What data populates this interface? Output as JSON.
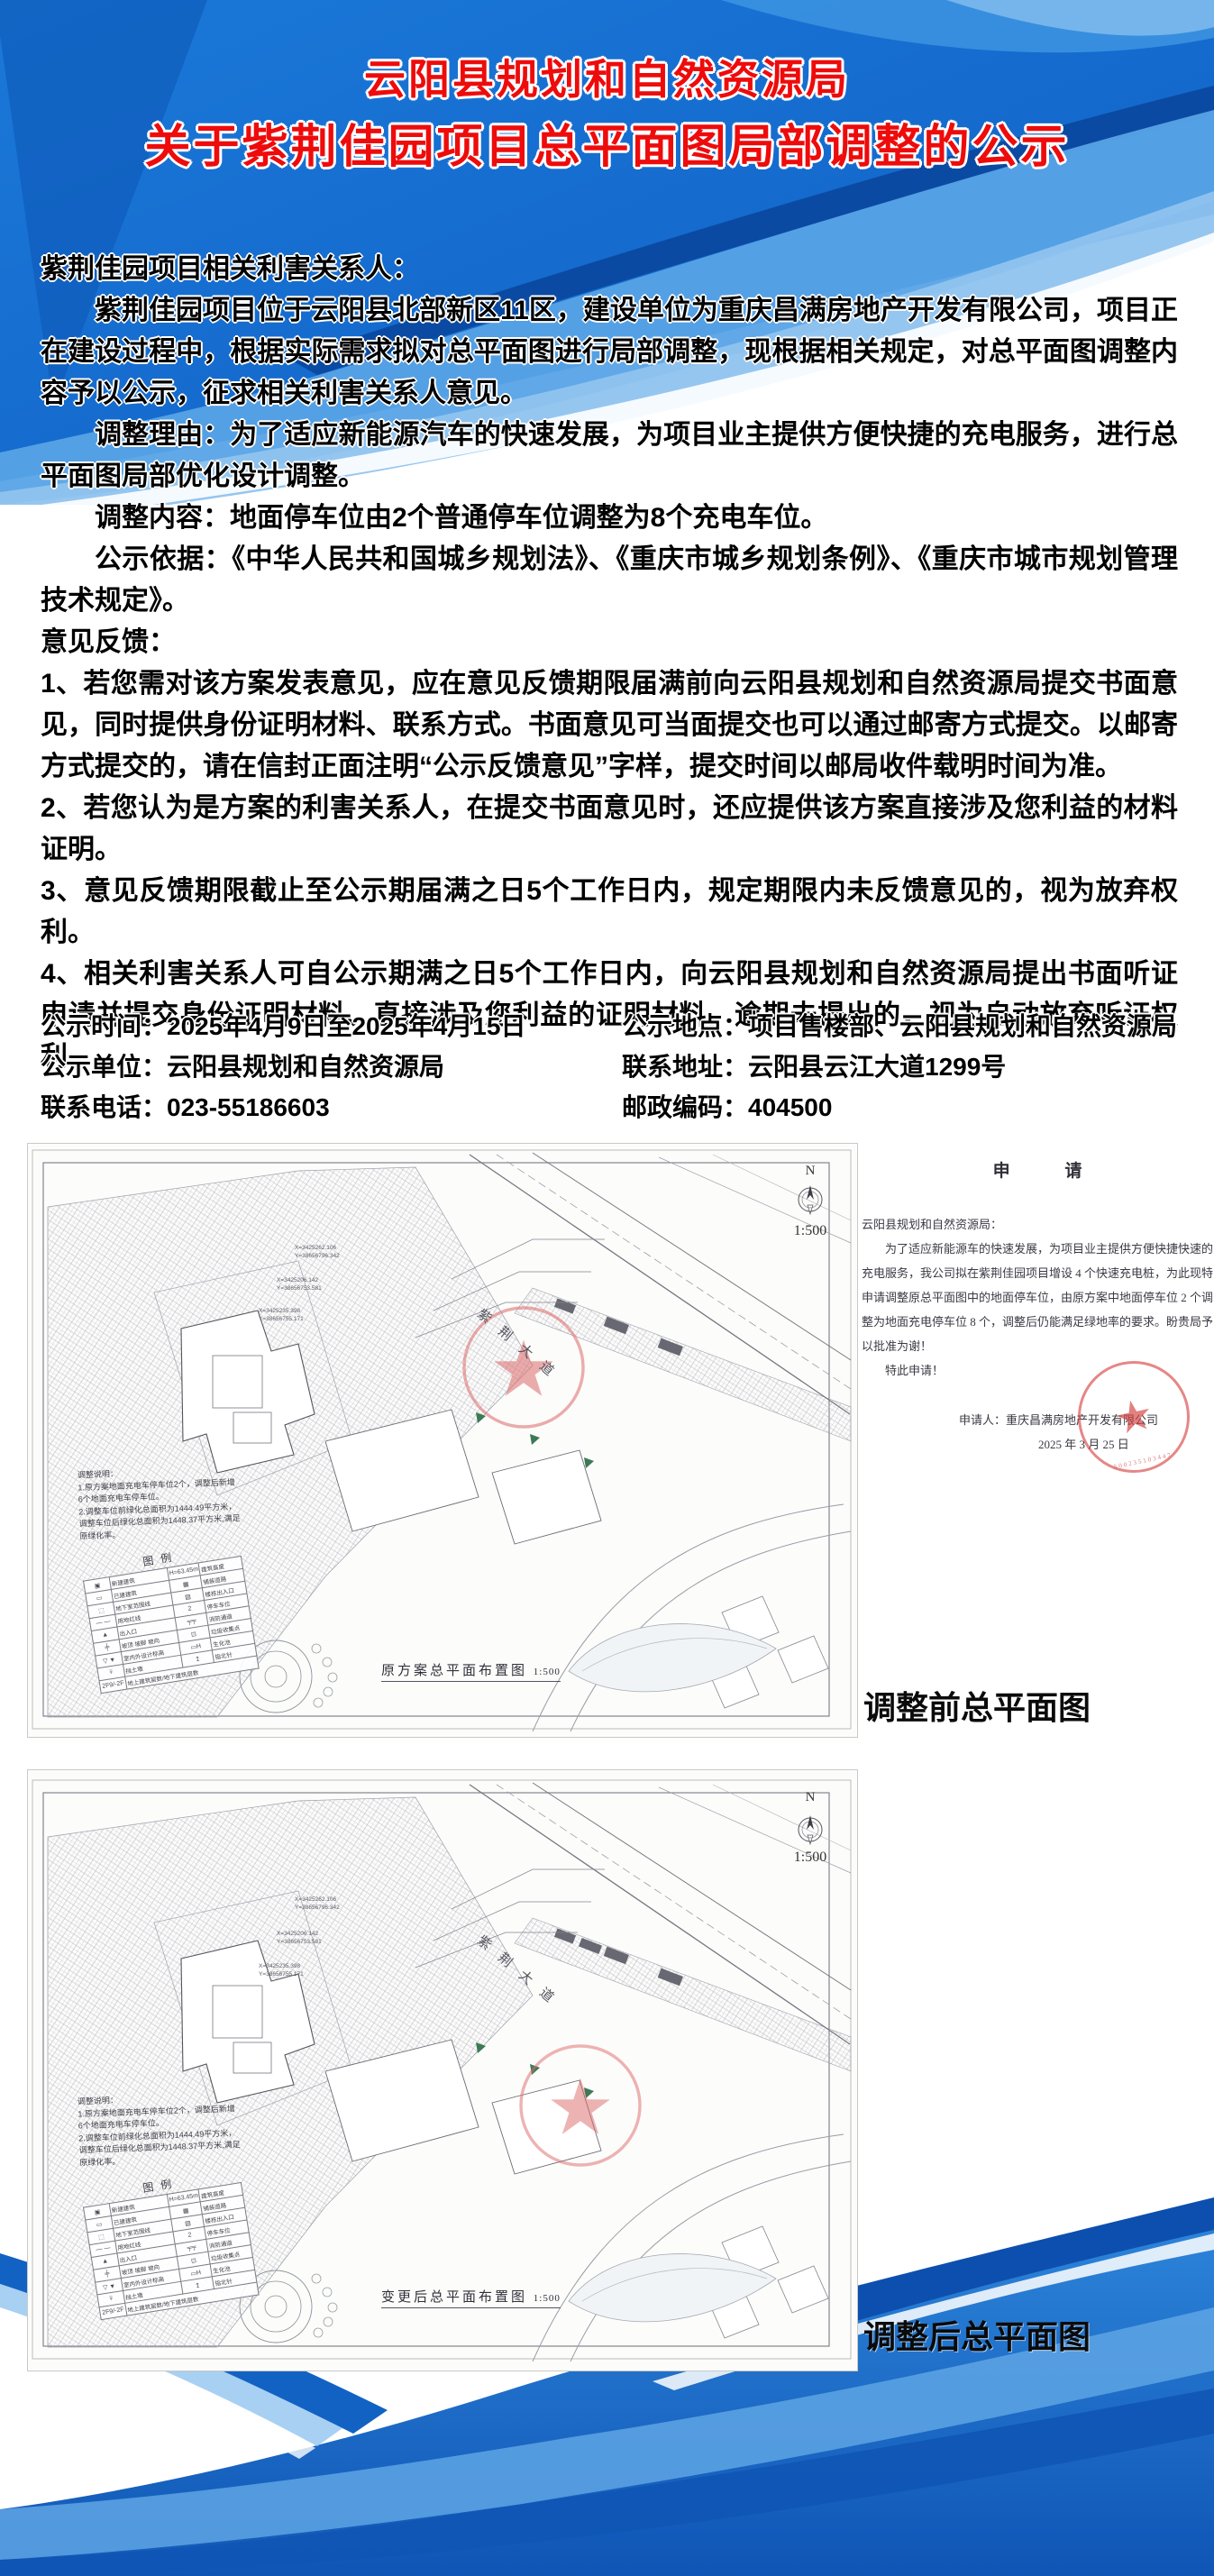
{
  "colors": {
    "accent_blue": "#1668c7",
    "deep_blue": "#0d4fae",
    "light_blue": "#8fc3ef",
    "title_red": "#ee0b0b",
    "stamp_red": "#d53e3e"
  },
  "header": {
    "title_line1": "云阳县规划和自然资源局",
    "title_line2": "关于紫荆佳园项目总平面图局部调整的公示"
  },
  "notice": {
    "salutation": "紫荆佳园项目相关利害关系人：",
    "paragraphs": [
      "紫荆佳园项目位于云阳县北部新区11区，建设单位为重庆昌满房地产开发有限公司，项目正在建设过程中，根据实际需求拟对总平面图进行局部调整，现根据相关规定，对总平面图调整内容予以公示，征求相关利害关系人意见。",
      "调整理由：为了适应新能源汽车的快速发展，为项目业主提供方便快捷的充电服务，进行总平面图局部优化设计调整。",
      "调整内容：地面停车位由2个普通停车位调整为8个充电车位。",
      "公示依据：《中华人民共和国城乡规划法》、《重庆市城乡规划条例》、《重庆市城市规划管理技术规定》。"
    ],
    "feedback_heading": "意见反馈：",
    "feedback_items": [
      "1、若您需对该方案发表意见，应在意见反馈期限届满前向云阳县规划和自然资源局提交书面意见，同时提供身份证明材料、联系方式。书面意见可当面提交也可以通过邮寄方式提交。以邮寄方式提交的，请在信封正面注明“公示反馈意见”字样，提交时间以邮局收件载明时间为准。",
      "2、若您认为是方案的利害关系人，在提交书面意见时，还应提供该方案直接涉及您利益的材料证明。",
      "3、意见反馈期限截止至公示期届满之日5个工作日内，规定期限内未反馈意见的，视为放弃权利。",
      "4、相关利害关系人可自公示期满之日5个工作日内，向云阳县规划和自然资源局提出书面听证申请并提交身份证明材料、直接涉及您利益的证明材料。逾期未提出的，视为自动放弃听证权利。"
    ]
  },
  "info": {
    "left": [
      {
        "label": "公示时间：",
        "value": "2025年4月9日至2025年4月15日"
      },
      {
        "label": "公示单位：",
        "value": "云阳县规划和自然资源局"
      },
      {
        "label": "联系电话：",
        "value": "023-55186603"
      }
    ],
    "right": [
      {
        "label": "公示地点：",
        "value": "项目售楼部、云阳县规划和自然资源局"
      },
      {
        "label": "联系地址：",
        "value": "云阳县云江大道1299号"
      },
      {
        "label": "邮政编码：",
        "value": "404500"
      }
    ]
  },
  "plans": [
    {
      "caption": "调整前总平面图",
      "drawing_title": "原方案总平面布置图",
      "scale": "1:500",
      "north": "N"
    },
    {
      "caption": "调整后总平面图",
      "drawing_title": "变更后总平面布置图",
      "scale": "1:500",
      "north": "N"
    }
  ],
  "plan_common": {
    "road_label": "紫荆大道",
    "note_title": "调整说明：",
    "note_lines": [
      "1.原方案地面充电车停车位2个，调整后新增",
      "6个地面充电车停车位。",
      "2.调整车位前绿化总面积为1444.49平方米，",
      "调整车位后绿化总面积为1448.37平方米,满足",
      "原绿化率。"
    ],
    "legend_title": "图例",
    "legend_rows": [
      [
        "▣",
        "新建建筑",
        "H=63.45m",
        "建筑高度"
      ],
      [
        "▭",
        "已建建筑",
        "▦",
        "铺装道路"
      ],
      [
        "⬚",
        "地下室范围线",
        "▨",
        "楼栋出入口"
      ],
      [
        "— —",
        "用地红线",
        "2",
        "停车车位"
      ],
      [
        "▲",
        "出入口",
        "╤╤",
        "消防通道"
      ],
      [
        "╪",
        "坡顶 坡脚 坡向",
        "⊡",
        "垃圾收集点"
      ],
      [
        "▽ ▼",
        "室内外设计标高",
        "▭H",
        "生化池"
      ],
      [
        "⍫",
        "挡土墙",
        "↥",
        "指北针"
      ],
      [
        "2F9/-2F",
        "地上建筑层数/地下建筑层数",
        "",
        ""
      ]
    ],
    "coord_labels": [
      "X=3425262.106",
      "Y=38656796.342",
      "X=3425206.142",
      "Y=38656753.581",
      "X=3425235.398",
      "Y=38656755.171"
    ]
  },
  "letter": {
    "title": "申  请",
    "salutation": "云阳县规划和自然资源局：",
    "body_lines": [
      "为了适应新能源车的快速发展，为项目业主提供方便快捷快速的充电服务，我公司拟在紫荆佳园项目增设 4 个快速充电桩，为此现特申请调整原总平面图中的地面停车位，由原方案中地面停车位 2 个调整为地面充电停车位 8 个，调整后仍能满足绿地率的要求。盼贵局予以批准为谢！",
      "特此申请！"
    ],
    "applicant_label": "申请人：",
    "applicant": "重庆昌满房地产开发有限公司",
    "date": "2025 年 3 月 25 日",
    "stamp_star": "★",
    "stamp_number": "500235103447"
  }
}
